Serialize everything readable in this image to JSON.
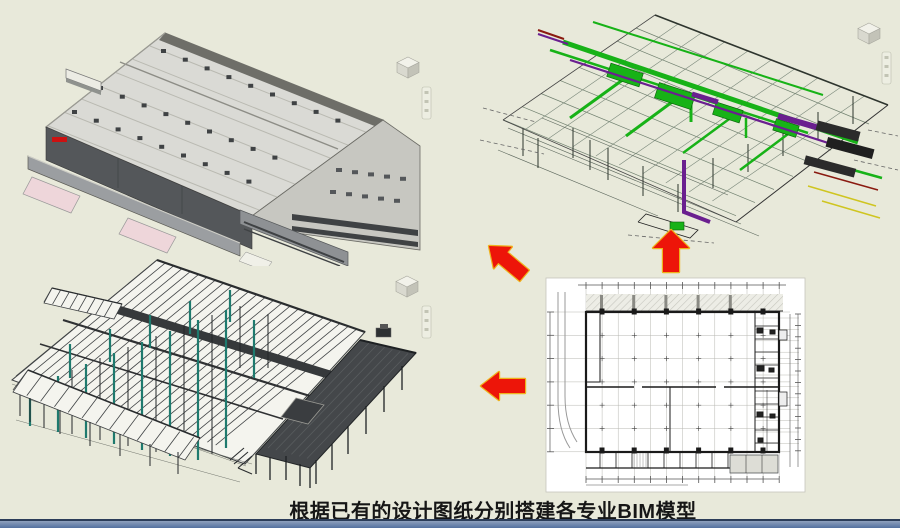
{
  "caption": {
    "text": "根据已有的设计图纸分别搭建各专业BIM模型"
  },
  "colors": {
    "background": "#e8e9da",
    "footer_bar_top": "#8ea0bd",
    "footer_bar_bottom": "#54719f",
    "arrow_fill": "#ed1509",
    "arrow_outline": "#eeb21c",
    "mep_green": "#17b217",
    "mep_green_dark": "#0a5c0a",
    "mep_purple": "#6a1f8f",
    "mep_red": "#8a1a10",
    "mep_yellow": "#cfc520",
    "steel_dark": "#3d4042",
    "steel_teal": "#1e7a6e",
    "roof_light": "#dadad5",
    "wall_dark": "#54575a",
    "canopy_gray": "#9b9ea1",
    "ramp_pink": "#eed6da",
    "logo_red": "#cc1111",
    "office_wall": "#c7c7c1",
    "paper_white": "#ffffff",
    "plan_line_dark": "#1a1a1a"
  },
  "icons": {
    "viewcube": "viewcube-icon",
    "navigation_bar": "navigation-bar-icon",
    "arrows": [
      "arrow-up-left-icon",
      "arrow-up-icon",
      "arrow-left-icon"
    ]
  }
}
